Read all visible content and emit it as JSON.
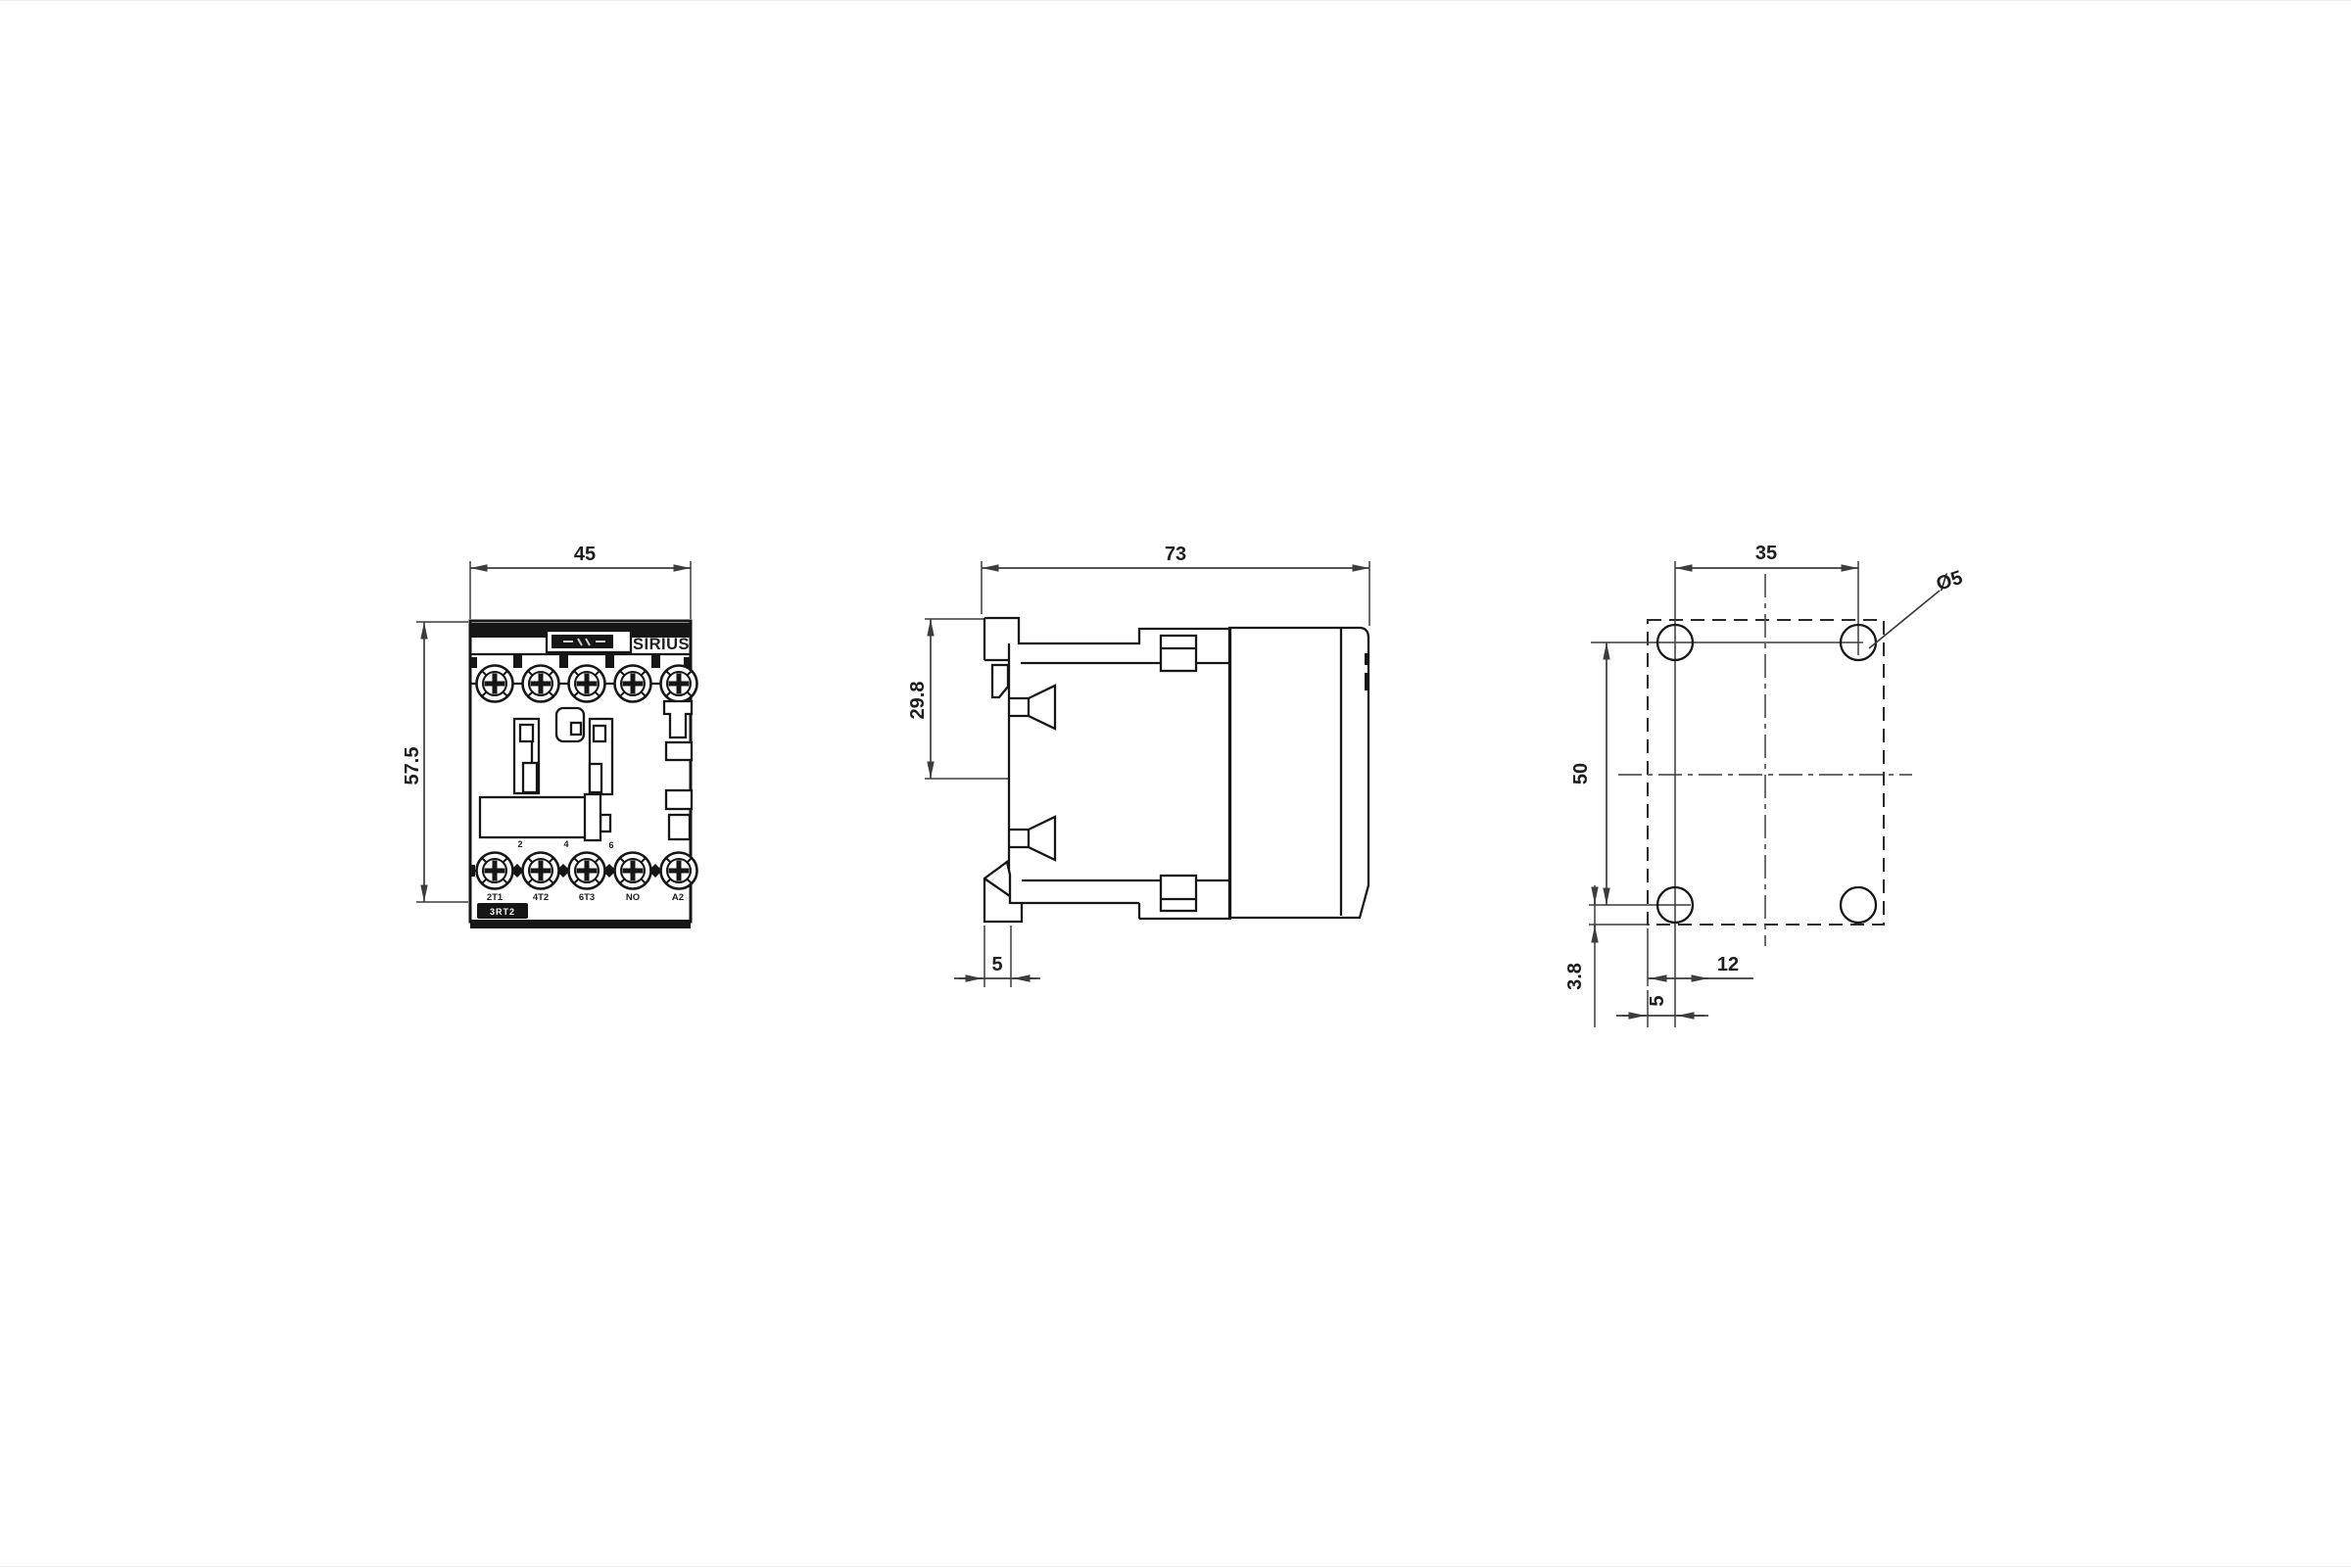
{
  "drawing": {
    "front": {
      "dim_width": "45",
      "dim_height": "57.5",
      "brand": "SIRIUS",
      "part_badge": "3RT2",
      "terminal_numbers": [
        "2",
        "4",
        "6"
      ],
      "terminals": [
        "2T1",
        "4T2",
        "6T3",
        "NO",
        "A2"
      ]
    },
    "side": {
      "dim_width": "73",
      "dim_clip_height": "29.8",
      "dim_rail_depth": "5"
    },
    "drill": {
      "dim_hole_spacing_h": "35",
      "dim_hole_spacing_v": "50",
      "dim_bottom_offset": "3.8",
      "dim_slot": "12",
      "dim_hole_offset": "5",
      "hole_diameter": "Ø5"
    }
  },
  "colors": {
    "line": "#161616",
    "dim": "#3c3c3c",
    "background": "#ffffff"
  }
}
